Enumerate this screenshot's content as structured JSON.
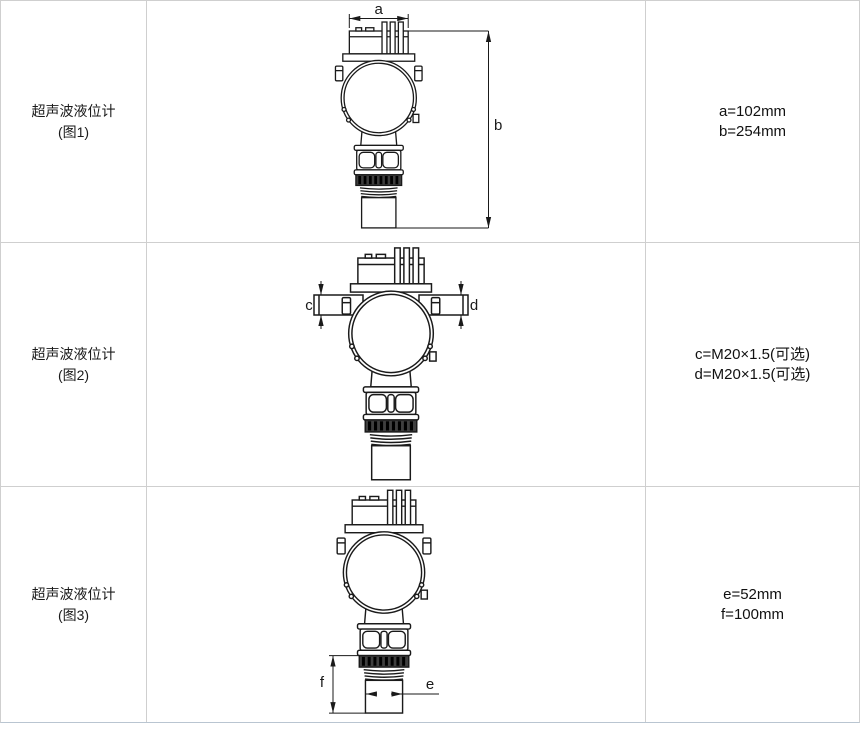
{
  "colors": {
    "table_border": "#cfcfcf",
    "table_bottom_border": "#b9c5d1",
    "drawing_line": "#1a1a1a",
    "knurl_fill": "#3f3f3f"
  },
  "rows": [
    {
      "label_line1": "超声波液位计",
      "label_line2": "(图1)",
      "dims": {
        "first": "a",
        "second": "b"
      },
      "spec_line1": "a=102mm",
      "spec_line2": "b=254mm"
    },
    {
      "label_line1": "超声波液位计",
      "label_line2": "(图2)",
      "dims": {
        "first": "c",
        "second": "d"
      },
      "spec_line1": "c=M20×1.5(可选)",
      "spec_line2": "d=M20×1.5(可选)"
    },
    {
      "label_line1": "超声波液位计",
      "label_line2": "(图3)",
      "dims": {
        "first": "e",
        "second": "f"
      },
      "spec_line1": "e=52mm",
      "spec_line2": "f=100mm"
    }
  ]
}
